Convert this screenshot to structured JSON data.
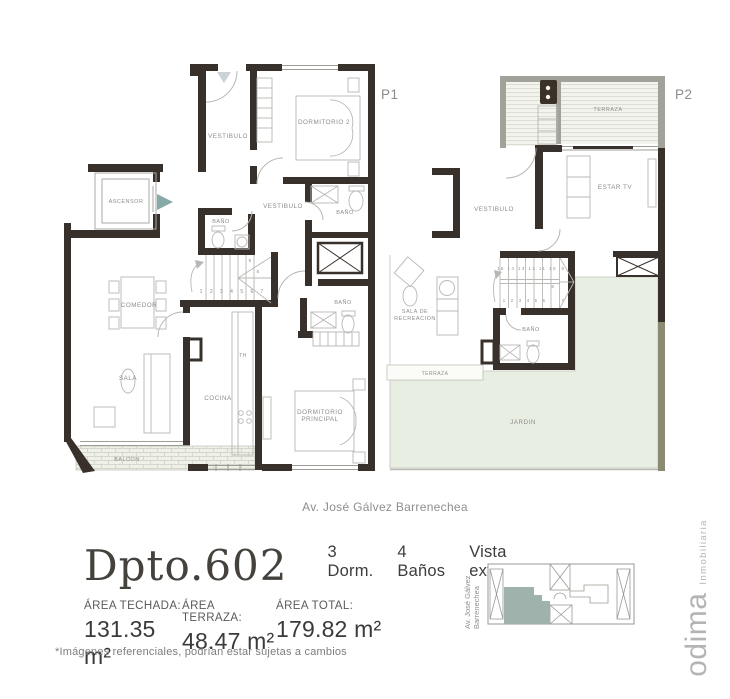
{
  "plans": {
    "p1": {
      "tag": "P1",
      "labels": [
        {
          "t": "VESTIBULO",
          "x": 228,
          "y": 138
        },
        {
          "t": "DORMITORIO 2",
          "x": 324,
          "y": 124
        },
        {
          "t": "ASCENSOR",
          "x": 126,
          "y": 203,
          "fs": 5.5
        },
        {
          "t": "BAÑO",
          "x": 221,
          "y": 223,
          "fs": 5.5
        },
        {
          "t": "VESTIBULO",
          "x": 283,
          "y": 208
        },
        {
          "t": "BAÑO",
          "x": 345,
          "y": 214,
          "fs": 5.5
        },
        {
          "t": "BAÑO",
          "x": 343,
          "y": 304,
          "fs": 5.5
        },
        {
          "t": "COMEDOR",
          "x": 139,
          "y": 307
        },
        {
          "t": "SALA",
          "x": 128,
          "y": 380
        },
        {
          "t": "COCINA",
          "x": 218,
          "y": 400
        },
        {
          "t": "TH",
          "x": 243,
          "y": 357,
          "fs": 5
        },
        {
          "t": "DORMITORIO\nPRINCIPAL",
          "x": 320,
          "y": 414
        },
        {
          "t": "BALCON",
          "x": 127,
          "y": 461,
          "fs": 5.5
        },
        {
          "t": "1 2 3 4 5 6",
          "x": 228,
          "y": 293,
          "fs": 5,
          "ls": 3
        },
        {
          "t": "7",
          "x": 262,
          "y": 293,
          "fs": 5
        },
        {
          "t": "8",
          "x": 258,
          "y": 273,
          "fs": 4.5
        },
        {
          "t": "9",
          "x": 250,
          "y": 262,
          "fs": 4.5
        }
      ]
    },
    "p2": {
      "tag": "P2",
      "labels": [
        {
          "t": "TERRAZA",
          "x": 608,
          "y": 111,
          "fs": 5.5
        },
        {
          "t": "ESTAR TV",
          "x": 615,
          "y": 189
        },
        {
          "t": "VESTIBULO",
          "x": 494,
          "y": 211
        },
        {
          "t": "SALA DE\nRECREACION",
          "x": 415,
          "y": 313,
          "fs": 5.5
        },
        {
          "t": "BAÑO",
          "x": 531,
          "y": 331,
          "fs": 5.5
        },
        {
          "t": "TERRAZA",
          "x": 435,
          "y": 375,
          "fs": 5
        },
        {
          "t": "JARDIN",
          "x": 523,
          "y": 424
        },
        {
          "t": "15 14 13 12 11 10",
          "x": 527,
          "y": 270,
          "fs": 4.3,
          "ls": 1.5
        },
        {
          "t": "9",
          "x": 563,
          "y": 270,
          "fs": 4.3
        },
        {
          "t": "1 2 3 4 5 6",
          "x": 525,
          "y": 302,
          "fs": 4.3,
          "ls": 2.2
        },
        {
          "t": "7",
          "x": 563,
          "y": 302,
          "fs": 4.3
        },
        {
          "t": "8",
          "x": 553,
          "y": 288,
          "fs": 4.3
        }
      ]
    }
  },
  "street_label": "Av. José Gálvez Barrenechea",
  "info": {
    "unit_title": "Dpto.602",
    "specs": [
      {
        "label": "3 Dorm."
      },
      {
        "label": "4 Baños"
      },
      {
        "label": "Vista externa"
      }
    ],
    "areas": [
      {
        "label": "ÁREA TECHADA:",
        "value": "131.35 m²"
      },
      {
        "label": "ÁREA TERRAZA:",
        "value": "48.47 m²"
      },
      {
        "label": "ÁREA TOTAL:",
        "value": "179.82 m²"
      }
    ],
    "disclaimer": "*Imágenes referenciales, podrían estar sujetas a cambios"
  },
  "minimap": {
    "street_line1": "Av. José Gálvez",
    "street_line2": "Barrenechea"
  },
  "brand": {
    "name": "odima",
    "tagline": "Inmobiliaria"
  },
  "colors": {
    "wall": "#38302a",
    "gray_wall": "#a2a29a",
    "olive_wall": "#8b8b74",
    "jardin": "#e8eee1",
    "terraza_bg": "#f4f4ef",
    "unit_highlight": "#9fb3ac",
    "entry_arrow": "#87aaa6",
    "brand_gray": "#b4b4b4"
  }
}
